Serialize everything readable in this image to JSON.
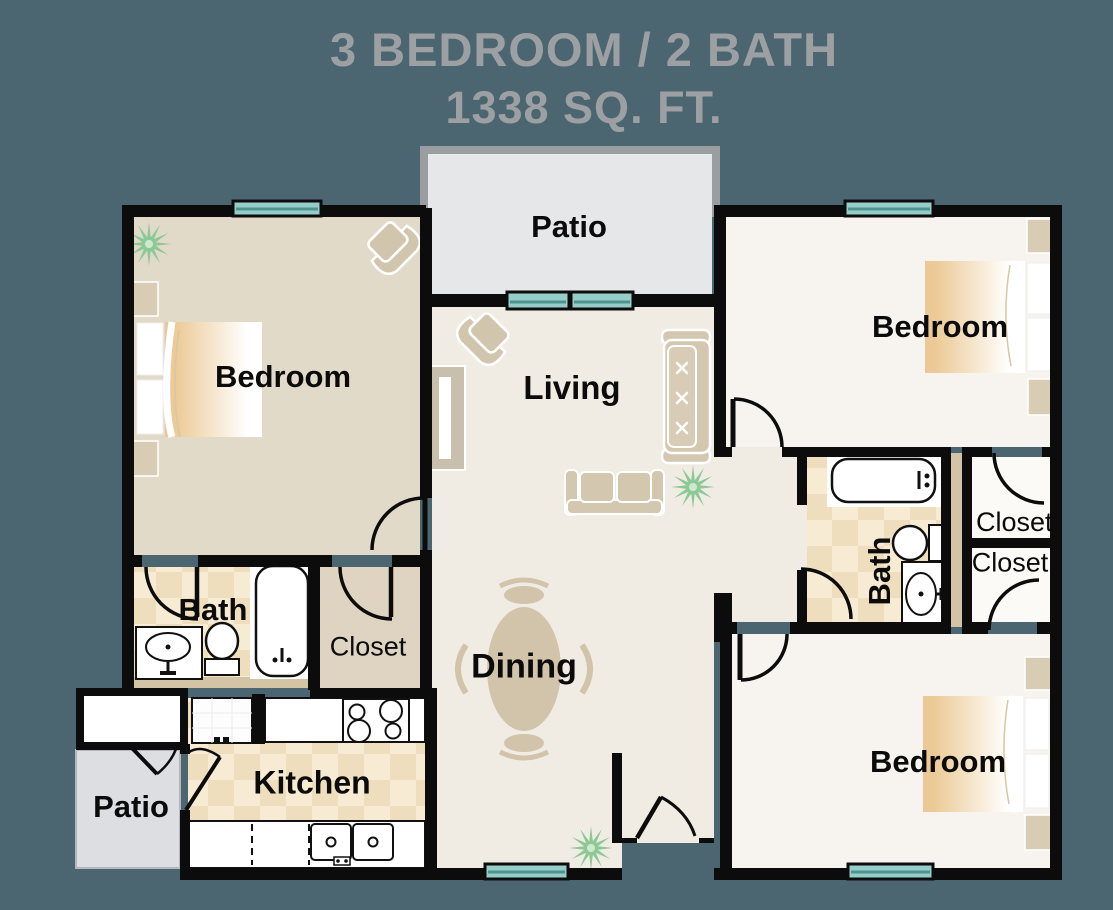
{
  "title": {
    "line1": "3 BEDROOM / 2 BATH",
    "line2": "1338 SQ. FT."
  },
  "rooms": {
    "patio_top": "Patio",
    "bedroom_left": "Bedroom",
    "living": "Living",
    "bedroom_top_right": "Bedroom",
    "bath_left": "Bath",
    "closet_left": "Closet",
    "dining": "Dining",
    "kitchen": "Kitchen",
    "patio_bottom": "Patio",
    "bath_right": "Bath",
    "closet_right_top": "Closet",
    "closet_right_bottom": "Closet",
    "bedroom_bottom_right": "Bedroom"
  },
  "colors": {
    "background": "#4c6671",
    "title_text": "#9da0a3",
    "wall_black": "#0c0c0c",
    "patio_wall_gray": "#9b9ea1",
    "patio_floor": "#e6e7e9",
    "patio_bottom_floor": "#dcdee1",
    "window_glass": "#97cdc9",
    "window_mullion": "#4e938f",
    "floor_bedroom_tan": "#e2dac8",
    "floor_living_cream": "#f1ece3",
    "floor_bedroom_white": "#f7f4ef",
    "floor_closet_white": "#fbfaf7",
    "checker_light": "#f7ebd4",
    "checker_dark": "#efdebe",
    "furniture_tan": "#d4c7b0",
    "bed_blanket_tan": "#ebc795",
    "plant_green": "#8cc996",
    "plumbing_wall_tan": "#d3c4a6",
    "label_text": "#0b0b0b"
  },
  "furniture_icons": [
    "bed-icon",
    "nightstand-icon",
    "plant-icon",
    "armchair-icon",
    "sofa-icon",
    "loveseat-icon",
    "tv-console-icon",
    "dining-table-icon",
    "dining-chair-icon",
    "bathtub-icon",
    "toilet-icon",
    "sink-icon",
    "refrigerator-icon",
    "stove-icon",
    "kitchen-sink-icon",
    "dishwasher-icon",
    "window-icon",
    "sliding-door-icon",
    "door-swing-icon",
    "storage-closet-icon"
  ]
}
